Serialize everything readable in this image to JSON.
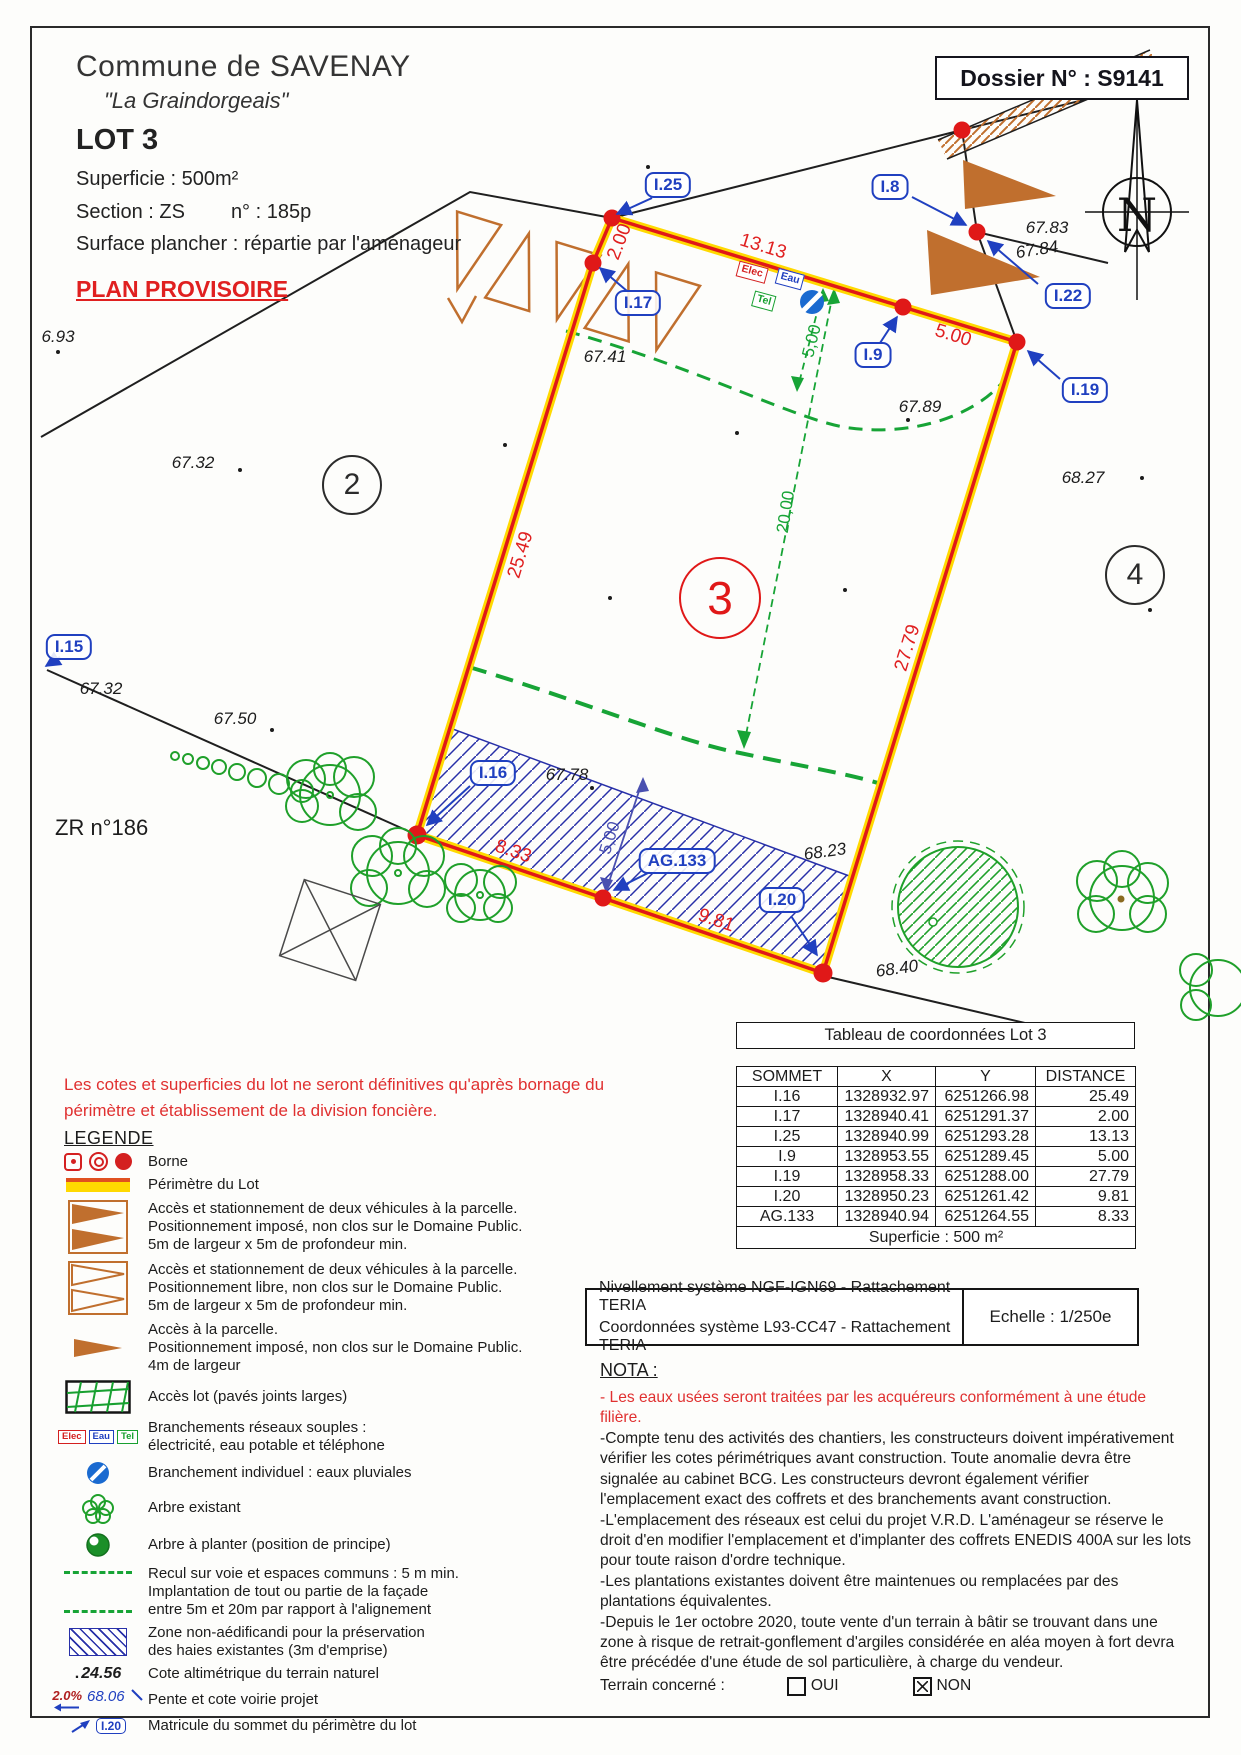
{
  "header": {
    "commune": "Commune de SAVENAY",
    "lieu_dit": "\"La Graindorgeais\"",
    "lot": "LOT 3",
    "superficie": "Superficie :  500m²",
    "section": "Section : ZS",
    "numero": "n° : 185p",
    "surface_plancher": "Surface plancher : répartie par l'aménageur",
    "plan_provisoire": "PLAN PROVISOIRE"
  },
  "dossier": {
    "label": "Dossier N° : S9141"
  },
  "map": {
    "north": "N",
    "zr": "ZR n°186",
    "parcels": {
      "p2": "2",
      "p3": "3",
      "p4": "4"
    },
    "labels": {
      "i25": "I.25",
      "i8": "I.8",
      "i17": "I.17",
      "i9": "I.9",
      "i22": "I.22",
      "i19": "I.19",
      "i15": "I.15",
      "i16": "I.16",
      "ag133": "AG.133",
      "i20": "I.20"
    },
    "dims": {
      "d200": "2.00",
      "d1313": "13.13",
      "d500": "5.00",
      "d2549": "25.49",
      "d2779": "27.79",
      "d833": "8.33",
      "d981": "9.81",
      "g500": "5,00",
      "g2000": "20,00",
      "b500": "5,00"
    },
    "elev": {
      "e693": "6.93",
      "e6732a": "67.32",
      "e6741": "67.41",
      "e6783": "67.83",
      "e6784": "67.84",
      "e6789": "67.89",
      "e6827": "68.27",
      "e6732b": "67.32",
      "e6750": "67.50",
      "e6778": "67.78",
      "e6823": "68.23",
      "e6840": "68.40"
    },
    "utils": {
      "elec": "Elec",
      "eau": "Eau",
      "tel": "Tel"
    }
  },
  "table": {
    "title": "Tableau de coordonnées Lot 3",
    "headers": [
      "SOMMET",
      "X",
      "Y",
      "DISTANCE"
    ],
    "rows": [
      [
        "I.16",
        "1328932.97",
        "6251266.98",
        "25.49"
      ],
      [
        "I.17",
        "1328940.41",
        "6251291.37",
        "2.00"
      ],
      [
        "I.25",
        "1328940.99",
        "6251293.28",
        "13.13"
      ],
      [
        "I.9",
        "1328953.55",
        "6251289.45",
        "5.00"
      ],
      [
        "I.19",
        "1328958.33",
        "6251288.00",
        "27.79"
      ],
      [
        "I.20",
        "1328950.23",
        "6251261.42",
        "9.81"
      ],
      [
        "AG.133",
        "1328940.94",
        "6251264.55",
        "8.33"
      ]
    ],
    "footer": "Superficie : 500 m²"
  },
  "survey_info": {
    "line1": "Nivellement système NGF-IGN69 - Rattachement TERIA",
    "line2": "Coordonnées système L93-CC47  - Rattachement TERIA",
    "echelle": "Echelle : 1/250e"
  },
  "warning": "Les cotes et superficies du lot ne seront définitives qu'après bornage du périmètre et établissement de la division foncière.",
  "legend": {
    "title": "LEGENDE",
    "cote_sample": "24.56",
    "pente_percent": "2.0%",
    "pente_cote": "68.06",
    "matricule_sample": "I.20",
    "items": [
      {
        "l1": "Borne"
      },
      {
        "l1": "Périmètre du Lot"
      },
      {
        "l1": "Accès et stationnement de deux véhicules à la parcelle.",
        "l2": "Positionnement imposé, non clos sur le Domaine Public.",
        "l3": "5m de largeur x 5m de profondeur min."
      },
      {
        "l1": "Accès et stationnement de deux véhicules à la parcelle.",
        "l2": "Positionnement libre, non clos sur le Domaine Public.",
        "l3": "5m de largeur x 5m de profondeur min."
      },
      {
        "l1": "Accès à la parcelle.",
        "l2": "Positionnement imposé, non clos sur le Domaine Public.",
        "l3": "4m de largeur"
      },
      {
        "l1": "Accès lot (pavés joints larges)"
      },
      {
        "l1": "Branchements réseaux souples :",
        "l2": "électricité, eau potable et téléphone"
      },
      {
        "l1": "Branchement individuel : eaux pluviales"
      },
      {
        "l1": "Arbre existant"
      },
      {
        "l1": "Arbre à planter (position de principe)"
      },
      {
        "l1": "Recul sur voie et espaces communs : 5 m min.",
        "l2": "Implantation de tout ou partie de la façade",
        "l3": "entre 5m et 20m par rapport à l'alignement"
      },
      {
        "l1": "Zone non-aédificandi pour la préservation",
        "l2": "des haies existantes (3m d'emprise)"
      },
      {
        "l1": "Cote altimétrique du terrain naturel"
      },
      {
        "l1": "Pente et cote voirie projet"
      },
      {
        "l1": "Matricule du sommet du périmètre du lot"
      }
    ]
  },
  "nota": {
    "title": "NOTA :",
    "red_item": "- Les eaux usées seront traitées par les acquéreurs conformément à une étude filière.",
    "items": [
      "-Compte tenu des activités des chantiers, les constructeurs doivent impérativement vérifier les cotes périmétriques avant construction. Toute anomalie devra être signalée au cabinet BCG. Les constructeurs devront également vérifier l'emplacement exact des coffrets et des branchements avant construction.",
      "-L'emplacement des réseaux est celui du projet V.R.D. L'aménageur se réserve le droit d'en modifier l'emplacement et d'implanter des coffrets ENEDIS 400A sur les lots pour toute raison d'ordre technique.",
      "-Les plantations existantes doivent être maintenues ou remplacées par des plantations équivalentes.",
      "-Depuis le 1er octobre 2020, toute vente d'un terrain à bâtir se trouvant dans une zone à risque de retrait-gonflement d'argiles considérée en aléa moyen à fort devra être précédée d'une étude de sol particulière, à charge du vendeur."
    ],
    "terrain": {
      "label": "Terrain concerné :",
      "oui": "OUI",
      "non": "NON"
    }
  },
  "colors": {
    "perimeter_red": "#e01818",
    "perimeter_yellow": "#ffd900",
    "setback_green": "#17a436",
    "tree_green": "#1fa02a",
    "label_blue": "#2040c0",
    "zone_blue": "#2830a8",
    "access_orange": "#c06f2e"
  }
}
